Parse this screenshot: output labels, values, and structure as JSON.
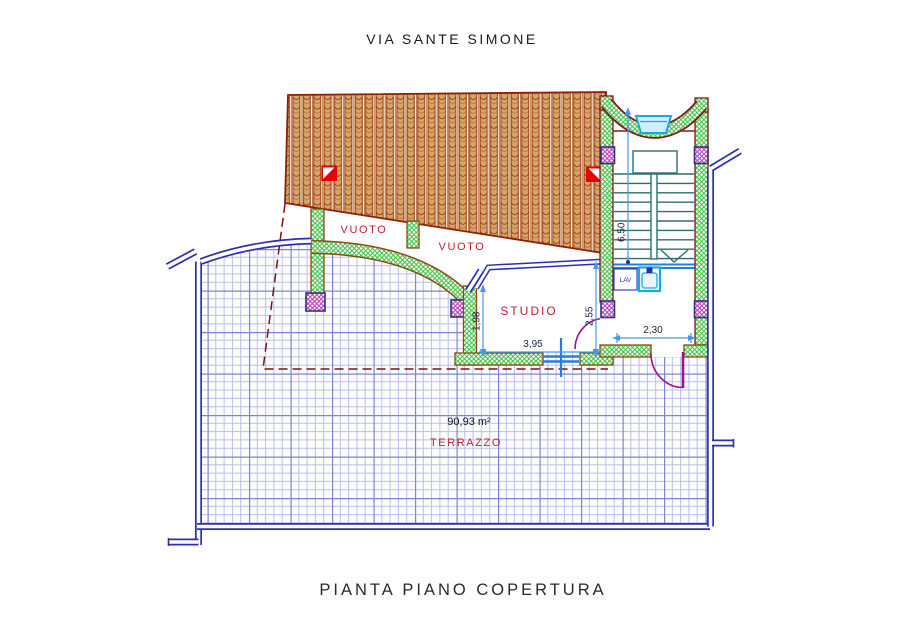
{
  "titles": {
    "street": "VIA SANTE SIMONE",
    "plan": "PIANTA PIANO COPERTURA"
  },
  "labels": {
    "vuoto_left": "VUOTO",
    "vuoto_right": "VUOTO",
    "studio": "STUDIO",
    "lav": "LAV",
    "terrazzo_name": "TERRAZZO",
    "terrazzo_area": "90,93 m²"
  },
  "dimensions": {
    "stairwell_depth": "6,50",
    "hall_width": "2,30",
    "studio_width": "3,95",
    "studio_left_height": "1,98",
    "studio_right_height": "2,55"
  },
  "colors": {
    "roof_tile": "#d7a567",
    "roof_line": "#943209",
    "wall_hatch_green": "#34bd36",
    "wall_outline_brown": "#8a4a10",
    "wall_outline_dark_red": "#7a1a1a",
    "pillar_purple": "#b13ab1",
    "railing_navy": "#2d2db5",
    "grid_minor": "#b9bdec",
    "grid_major": "#7e83d9",
    "dimension_blue": "#4499ee",
    "label_red": "#c01f2f",
    "door_magenta": "#9b1191",
    "stair_teal": "#2e6e6e",
    "fixture_cyan": "#17a9e0",
    "projection_dashed": "#7c1212",
    "skylight_red": "#e60000"
  }
}
